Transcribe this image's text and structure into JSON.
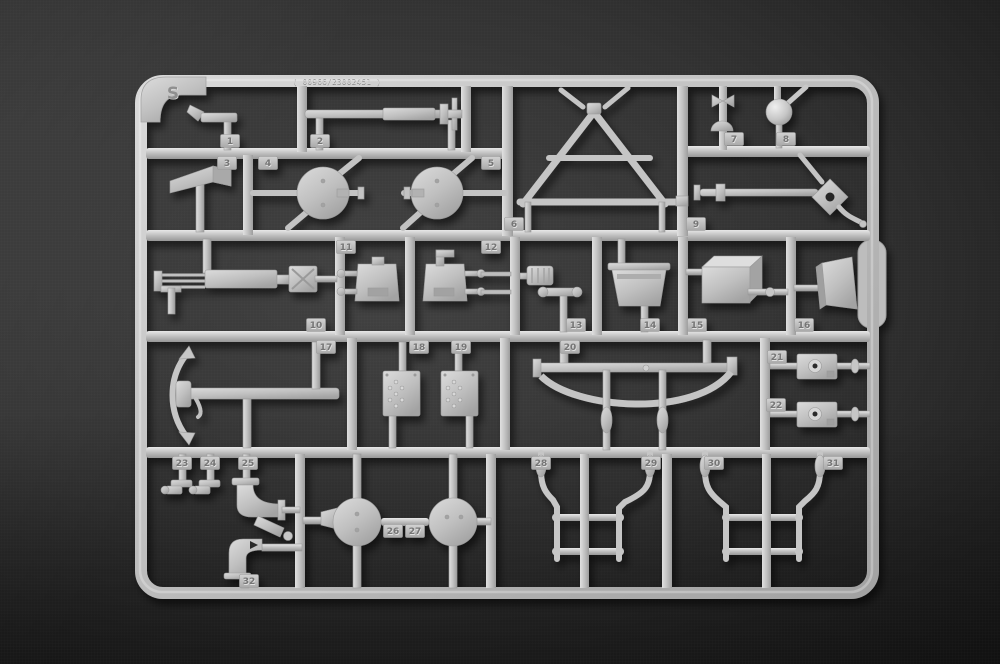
{
  "sprue": {
    "letter": "S",
    "mold_code": "( 00966/23002451 )",
    "part_numbers": [
      {
        "n": "1",
        "x": 230,
        "y": 141
      },
      {
        "n": "2",
        "x": 320,
        "y": 141
      },
      {
        "n": "3",
        "x": 227,
        "y": 163
      },
      {
        "n": "4",
        "x": 268,
        "y": 163
      },
      {
        "n": "5",
        "x": 491,
        "y": 163
      },
      {
        "n": "6",
        "x": 514,
        "y": 224
      },
      {
        "n": "7",
        "x": 734,
        "y": 139
      },
      {
        "n": "8",
        "x": 786,
        "y": 139
      },
      {
        "n": "9",
        "x": 696,
        "y": 224
      },
      {
        "n": "10",
        "x": 316,
        "y": 325
      },
      {
        "n": "11",
        "x": 346,
        "y": 247
      },
      {
        "n": "12",
        "x": 491,
        "y": 247
      },
      {
        "n": "13",
        "x": 576,
        "y": 325
      },
      {
        "n": "14",
        "x": 650,
        "y": 325
      },
      {
        "n": "15",
        "x": 697,
        "y": 325
      },
      {
        "n": "16",
        "x": 804,
        "y": 325
      },
      {
        "n": "17",
        "x": 326,
        "y": 347
      },
      {
        "n": "18",
        "x": 419,
        "y": 347
      },
      {
        "n": "19",
        "x": 461,
        "y": 347
      },
      {
        "n": "20",
        "x": 570,
        "y": 347
      },
      {
        "n": "21",
        "x": 777,
        "y": 357
      },
      {
        "n": "22",
        "x": 776,
        "y": 405
      },
      {
        "n": "23",
        "x": 182,
        "y": 463
      },
      {
        "n": "24",
        "x": 210,
        "y": 463
      },
      {
        "n": "25",
        "x": 248,
        "y": 463
      },
      {
        "n": "26",
        "x": 393,
        "y": 531
      },
      {
        "n": "27",
        "x": 415,
        "y": 531
      },
      {
        "n": "28",
        "x": 541,
        "y": 463
      },
      {
        "n": "29",
        "x": 651,
        "y": 463
      },
      {
        "n": "30",
        "x": 714,
        "y": 463
      },
      {
        "n": "31",
        "x": 833,
        "y": 463
      },
      {
        "n": "32",
        "x": 249,
        "y": 581
      }
    ],
    "colors": {
      "plastic_highlight": "#e2e2e2",
      "plastic_face": "#c2c2c2",
      "plastic_shadow": "#9a9a9a",
      "background_center": "#424242",
      "background_edge": "#0c0c0c"
    }
  }
}
